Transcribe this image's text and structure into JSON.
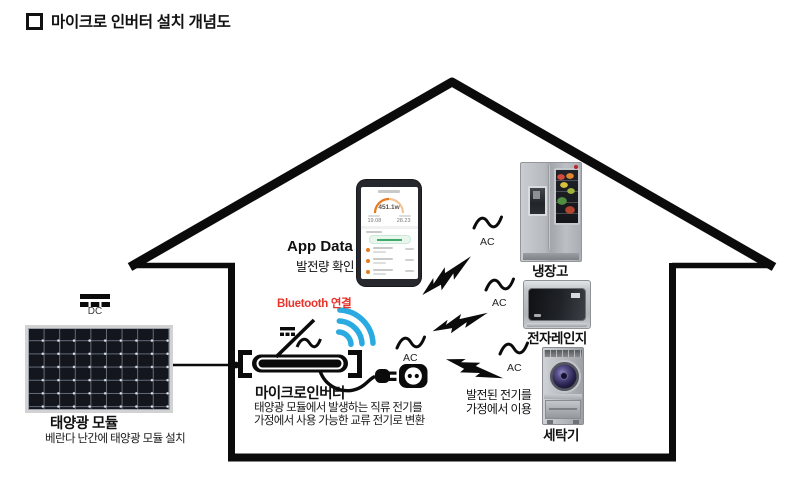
{
  "title": "마이크로 인버터 설치 개념도",
  "solar": {
    "dc_label": "DC",
    "name": "태양광 모듈",
    "caption": "베란다 난간에 태양광 모듈 설치"
  },
  "inverter": {
    "name": "마이크로인버터",
    "desc1": "태양광 모듈에서 발생하는 직류 전기를",
    "desc2": "가정에서 사용 가능한 교류 전기로 변환"
  },
  "bluetooth": {
    "label": "Bluetooth 연결"
  },
  "app": {
    "title": "App Data",
    "subtitle": "발전량 확인",
    "gauge_value": "451.1w",
    "stat_left": "19.08",
    "stat_right": "28.23"
  },
  "ac": {
    "label": "AC"
  },
  "appliances": {
    "fridge": "냉장고",
    "microwave": "전자레인지",
    "washer": "세탁기"
  },
  "usage": {
    "line1": "발전된 전기를",
    "line2": "가정에서 이용"
  },
  "colors": {
    "line_black": "#0b0b0b",
    "bluetooth_blue": "#29abe2",
    "bluetooth_label_red": "#e8332a",
    "app_accent_orange": "#e87b1e",
    "app_accent_green": "#3faa6a"
  }
}
